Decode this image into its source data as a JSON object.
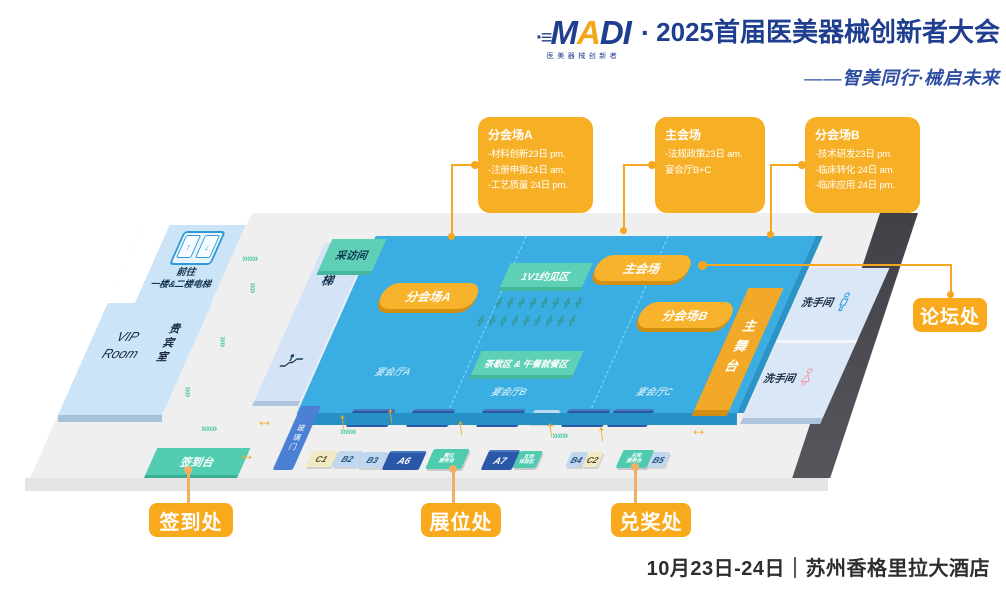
{
  "header": {
    "logo": "MADI",
    "logo_sub": "医美器械创新者",
    "separator": "·",
    "title": "2025首届医美器械创新者大会",
    "tagline": "——智美同行·械启未来"
  },
  "callouts": [
    {
      "title": "分会场A",
      "lines": [
        "-材料创新23日 pm.",
        "-注册申报24日 am.",
        "-工艺质量 24日 pm."
      ]
    },
    {
      "title": "主会场",
      "lines": [
        "-法规政策23日 am.",
        "宴会厅B+C"
      ]
    },
    {
      "title": "分会场B",
      "lines": [
        "-技术研发23日 pm.",
        "-临床转化 24日 am.",
        "-临床应用 24日 pm."
      ]
    }
  ],
  "map": {
    "elevator_note_line1": "前往",
    "elevator_note_line2": "一楼&二楼电梯",
    "vip_en": "VIP Room",
    "vip_cn": "贵宾室",
    "escalator": "扶梯",
    "interview_room": "采访间",
    "pill_sub_a": "分会场A",
    "pill_main": "主会场",
    "pill_sub_b": "分会场B",
    "meeting_zone": "1V1约见区",
    "tea_lunch_zone": "茶歇区 & 午餐就餐区",
    "hall_a": "宴会厅A",
    "hall_b": "宴会厅B",
    "hall_c": "宴会厅C",
    "stage": "主舞台",
    "restroom": "洗手间",
    "glass_door": "玻璃门",
    "signin_desk": "签到台",
    "booths_row1": [
      "A1",
      "A2",
      "A3",
      "B1",
      "A4",
      "A5"
    ],
    "booths_row2": [
      "C1",
      "B2",
      "B3",
      "A6",
      "A7",
      "B4",
      "C2",
      "B5"
    ],
    "service_booths": [
      {
        "line1": "展位",
        "line2": "服务台"
      },
      {
        "line1": "互动",
        "line2": "体验区"
      },
      {
        "line1": "兑奖",
        "line2": "服务台"
      }
    ]
  },
  "buttons": {
    "signin": "签到处",
    "booths": "展位处",
    "prize": "兑奖处",
    "forum": "论坛处"
  },
  "footer": {
    "date_venue": "10月23日-24日｜苏州香格里拉大酒店"
  },
  "colors": {
    "accent_orange": "#F5A71F",
    "callout_yellow": "#F7AF25",
    "hall_blue": "#3AAEE2",
    "teal_green": "#5ED0B6",
    "booth_navy": "#2A57A8",
    "light_blue": "#CCE4F7",
    "title_blue": "#1F3E8F"
  },
  "icons": {
    "elevator_up": "↑",
    "elevator_down": "↓",
    "walk_up_arrow": "↑",
    "two_way_arrow": "↔",
    "chevron_right": "»»»",
    "chevron_down": "»»",
    "seat": "╬"
  }
}
